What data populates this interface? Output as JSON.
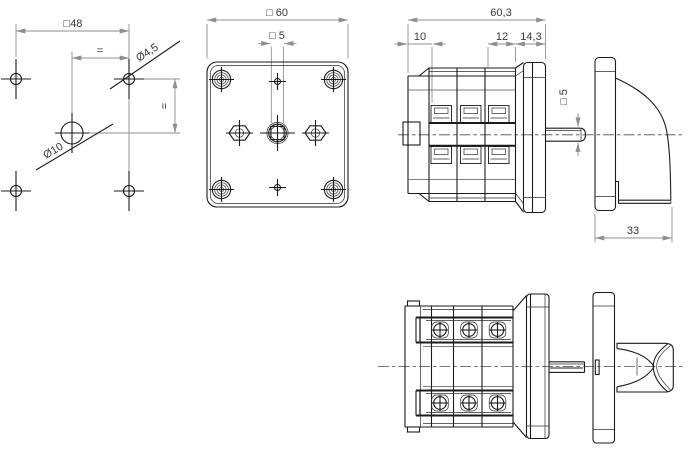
{
  "drawing": {
    "background": "#ffffff",
    "object_line_color": "#1b1b1b",
    "dimension_line_color": "#8f8f8f",
    "text_color": "#3a3a3a",
    "views": {
      "drilling_plan": {
        "dims": {
          "bolt_square": "□48",
          "equal_spacing_h": "=",
          "equal_spacing_v": "=",
          "fixing_hole_dia": "Ø4,5",
          "center_hole_dia": "Ø10"
        }
      },
      "front_view": {
        "dims": {
          "face_square": "□ 60",
          "shaft_square": "□ 5"
        }
      },
      "side_view": {
        "dims": {
          "overall_depth": "60,3",
          "front_section": "10",
          "rear_section": "12",
          "flange_section": "14,3",
          "shaft_square": "□ 5",
          "handle_depth": "33"
        }
      }
    }
  }
}
